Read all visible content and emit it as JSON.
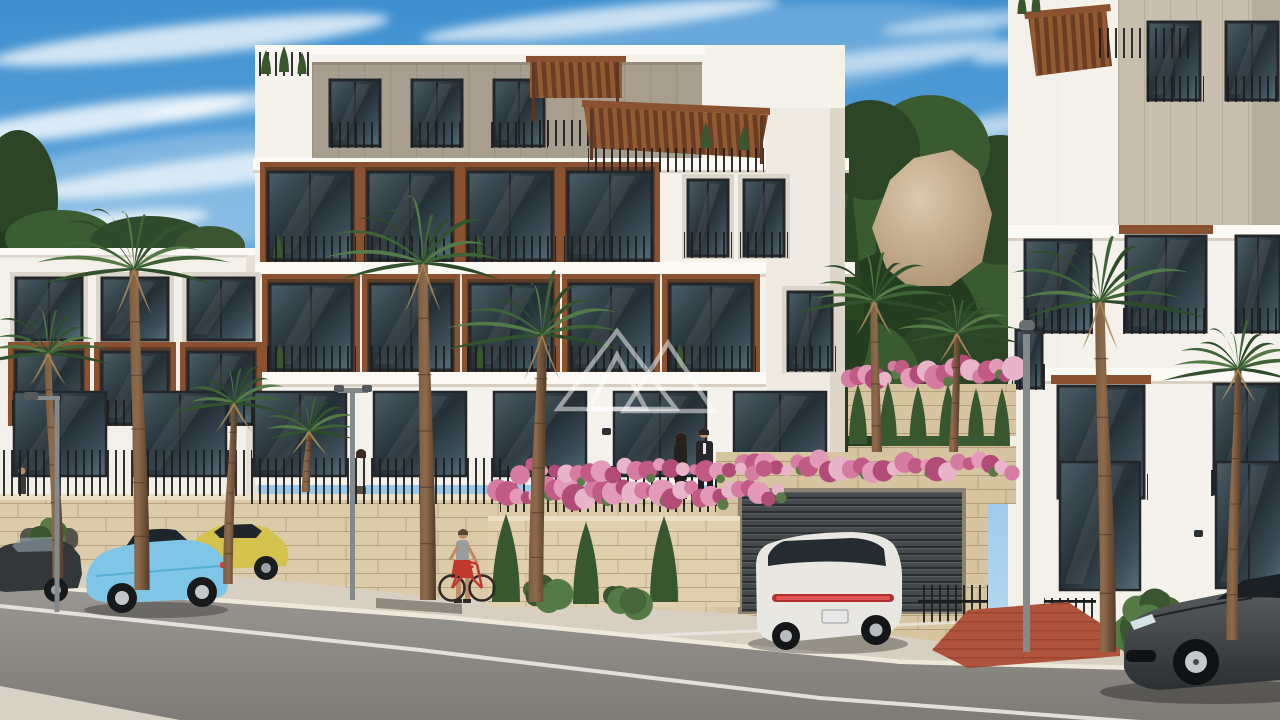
{
  "scene": {
    "type": "architectural-exterior-render",
    "description": "Sunny 3D architectural rendering of a modern white hillside apartment complex with wood pergola roof terraces, recessed wood-lined balconies, travertine stone retaining walls, an underground garage with dark roller door, a palm-lined street with parked cars, pedestrians, a cyclist, and a translucent triangle-logo watermark under a blue sky with streaky clouds",
    "time_of_day": "day",
    "watermark_style": "two overlapping translucent white triangle outlines"
  },
  "palette": {
    "sky_top": "#3e8fd0",
    "sky_low": "#c6dff2",
    "cloud": "#ffffff",
    "facade_white": "#f5f2ec",
    "facade_left": "#f3efe9",
    "facade_shade": "#e3dccf",
    "slab": "#fbf9f4",
    "penthouse_clad": "#a89e90",
    "beige_clad": "#c9bfae",
    "wood": "#8a5230",
    "wood_dark": "#6b3e23",
    "glass_dark": "#242f36",
    "frame_dark": "#23262a",
    "railing": "#1b1d1e",
    "stone": "#dccba8",
    "stone_dark": "#d6c5a0",
    "stone_line": "#96805c",
    "sidewalk": "#d7d0c2",
    "curb": "#efe9dc",
    "asphalt": "#8f8c86",
    "road_line": "#eceae4",
    "red_paving": "#b0533c",
    "garage_door": "#45494c",
    "forest_green": "#2c4527",
    "palm_green": "#3f6336",
    "cypress_green": "#39572f",
    "bougainvillea": "#d67ba1",
    "bougainvillea_deep": "#b14b78",
    "rock": "#c9b491",
    "car_blue": "#7fc5e8",
    "car_yellow": "#d4c24c",
    "car_white": "#e9e7e2",
    "car_dark": "#45484a",
    "car_black": "#34373a",
    "lamp_gray": "#84898c",
    "skin": "#bb8c67"
  },
  "sky": {
    "clouds": [
      [
        190,
        40,
        200,
        16,
        0.75,
        -6
      ],
      [
        90,
        120,
        160,
        14,
        0.8,
        -8
      ],
      [
        230,
        170,
        210,
        15,
        0.7,
        -7
      ],
      [
        60,
        230,
        150,
        13,
        0.75,
        -6
      ],
      [
        170,
        300,
        190,
        14,
        0.65,
        -8
      ],
      [
        40,
        370,
        140,
        12,
        0.6,
        -7
      ],
      [
        260,
        100,
        120,
        10,
        0.6,
        -10
      ],
      [
        120,
        420,
        150,
        10,
        0.5,
        -6
      ],
      [
        600,
        20,
        180,
        12,
        0.7,
        -6
      ],
      [
        880,
        60,
        140,
        11,
        0.55,
        -7
      ],
      [
        960,
        130,
        120,
        10,
        0.5,
        -6
      ],
      [
        1120,
        40,
        150,
        12,
        0.6,
        -8
      ],
      [
        1220,
        110,
        120,
        10,
        0.55,
        -7
      ],
      [
        1120,
        180,
        130,
        10,
        0.5,
        -6
      ],
      [
        1240,
        260,
        90,
        9,
        0.45,
        -7
      ],
      [
        990,
        20,
        110,
        9,
        0.5,
        -6
      ],
      [
        150,
        200,
        260,
        60,
        0.25,
        -8
      ],
      [
        700,
        60,
        300,
        50,
        0.2,
        -6
      ],
      [
        1150,
        120,
        200,
        45,
        0.2,
        -7
      ]
    ]
  },
  "windows": {
    "grids": [
      {
        "x": 330,
        "y": 80,
        "cols": 3,
        "w": 50,
        "h": 66,
        "gap": 32,
        "rail": true
      },
      {
        "x": 268,
        "y": 172,
        "cols": 4,
        "w": 84,
        "h": 88,
        "gap": 16,
        "wood": true,
        "rail": true,
        "plant": true
      },
      {
        "x": 688,
        "y": 180,
        "cols": 2,
        "w": 40,
        "h": 76,
        "gap": 16,
        "recess": "plain",
        "rail": true
      },
      {
        "x": 270,
        "y": 284,
        "cols": 5,
        "w": 82,
        "h": 86,
        "gap": 18,
        "wood": true,
        "rail": true,
        "plant": true
      },
      {
        "x": 788,
        "y": 292,
        "cols": 1,
        "w": 44,
        "h": 78,
        "gap": 0,
        "recess": "plain",
        "rail": true
      },
      {
        "x": 16,
        "y": 278,
        "cols": 3,
        "w": 66,
        "h": 62,
        "gap": 20,
        "recess": "plain"
      },
      {
        "x": 16,
        "y": 352,
        "cols": 3,
        "w": 66,
        "h": 72,
        "gap": 20,
        "wood": true,
        "rail": true
      },
      {
        "x": 14,
        "y": 392,
        "cols": 7,
        "w": 92,
        "h": 84,
        "gap": 28,
        "door": true
      },
      {
        "x": 1148,
        "y": 22,
        "cols": 2,
        "w": 52,
        "h": 78,
        "gap": 26,
        "rail": true
      },
      {
        "x": 1025,
        "y": 240,
        "cols": 1,
        "w": 66,
        "h": 92,
        "gap": 0,
        "rail": true
      },
      {
        "x": 1126,
        "y": 236,
        "cols": 1,
        "w": 80,
        "h": 96,
        "gap": 0,
        "rail": true,
        "lintel": true
      },
      {
        "x": 1236,
        "y": 236,
        "cols": 1,
        "w": 44,
        "h": 96,
        "gap": 0,
        "rail": true
      },
      {
        "x": 1016,
        "y": 330,
        "cols": 1,
        "w": 26,
        "h": 58,
        "gap": 0,
        "rail": true
      },
      {
        "x": 1058,
        "y": 386,
        "cols": 1,
        "w": 86,
        "h": 112,
        "gap": 0,
        "rail": true,
        "lintel": true
      },
      {
        "x": 1214,
        "y": 384,
        "cols": 1,
        "w": 66,
        "h": 110,
        "gap": 0,
        "rail": true
      },
      {
        "x": 1060,
        "y": 462,
        "cols": 1,
        "w": 80,
        "h": 128,
        "gap": 0,
        "door": true
      },
      {
        "x": 1216,
        "y": 462,
        "cols": 1,
        "w": 66,
        "h": 126,
        "gap": 0,
        "door": true
      }
    ]
  },
  "vegetation": {
    "street_palms": [
      [
        58,
        578,
        352,
        68,
        -10
      ],
      [
        142,
        590,
        268,
        95,
        -8
      ],
      [
        228,
        584,
        402,
        60,
        6
      ],
      [
        306,
        492,
        430,
        50,
        3
      ],
      [
        428,
        600,
        262,
        100,
        -5
      ],
      [
        536,
        602,
        334,
        92,
        6
      ],
      [
        1108,
        652,
        300,
        100,
        -8
      ],
      [
        1232,
        640,
        368,
        70,
        6
      ]
    ],
    "garden_palms": [
      [
        878,
        552,
        300,
        72,
        -4
      ],
      [
        952,
        545,
        332,
        62,
        5
      ]
    ],
    "cypresses": [
      {
        "l": "garden",
        "x": 858,
        "b": 444,
        "w": 18,
        "h": 60
      },
      {
        "l": "garden",
        "x": 888,
        "b": 446,
        "w": 18,
        "h": 64
      },
      {
        "l": "garden",
        "x": 918,
        "b": 444,
        "w": 17,
        "h": 58
      },
      {
        "l": "garden",
        "x": 948,
        "b": 446,
        "w": 18,
        "h": 62
      },
      {
        "l": "garden",
        "x": 976,
        "b": 444,
        "w": 16,
        "h": 56
      },
      {
        "l": "garden",
        "x": 1002,
        "b": 446,
        "w": 16,
        "h": 58
      },
      {
        "l": "flowerbed",
        "x": 506,
        "b": 602,
        "w": 28,
        "h": 88
      },
      {
        "l": "flowerbed",
        "x": 586,
        "b": 604,
        "w": 26,
        "h": 82
      },
      {
        "l": "flowerbed",
        "x": 664,
        "b": 602,
        "w": 28,
        "h": 86
      },
      {
        "l": "roof",
        "x": 266,
        "b": 74,
        "w": 10,
        "h": 24
      },
      {
        "l": "roof",
        "x": 284,
        "b": 72,
        "w": 10,
        "h": 26
      },
      {
        "l": "roof",
        "x": 302,
        "b": 74,
        "w": 9,
        "h": 22
      },
      {
        "l": "roof",
        "x": 706,
        "b": 148,
        "w": 10,
        "h": 26
      },
      {
        "l": "roof",
        "x": 744,
        "b": 150,
        "w": 10,
        "h": 24
      },
      {
        "l": "roof",
        "x": 1022,
        "b": 14,
        "w": 9,
        "h": 22
      },
      {
        "l": "roof",
        "x": 1036,
        "b": 12,
        "w": 9,
        "h": 24
      }
    ],
    "bushes": [
      {
        "l": "flowerbed",
        "x": 548,
        "y": 594,
        "r": 20
      },
      {
        "l": "flowerbed",
        "x": 628,
        "y": 596,
        "r": 20
      },
      {
        "l": "hedge",
        "x": 1128,
        "y": 636,
        "r": 26
      },
      {
        "l": "hedge",
        "x": 1152,
        "y": 614,
        "r": 22
      },
      {
        "l": "hedge",
        "x": 1172,
        "y": 638,
        "r": 24
      },
      {
        "l": "hedge",
        "x": 1250,
        "y": 626,
        "r": 24
      },
      {
        "l": "hedge",
        "x": 1270,
        "y": 602,
        "r": 20
      },
      {
        "l": "hedge",
        "x": 1282,
        "y": 636,
        "r": 22
      },
      {
        "l": "planter",
        "x": 48,
        "y": 534,
        "r": 16
      }
    ],
    "flower_rows": [
      {
        "l": "garden",
        "x0": 850,
        "x1": 1014,
        "y": 372,
        "n": 20,
        "r": 9
      },
      {
        "l": "garageTop",
        "x0": 744,
        "x1": 1012,
        "y": 466,
        "n": 26,
        "r": 9
      },
      {
        "l": "flowerbed",
        "x0": 498,
        "x1": 778,
        "y": 492,
        "n": 30,
        "r": 10
      },
      {
        "l": "flowerbed",
        "x0": 520,
        "x1": 764,
        "y": 470,
        "n": 22,
        "r": 8
      }
    ]
  },
  "vehicles": [
    {
      "name": "dark-sedan",
      "color": "car_black",
      "position": "far left, parked"
    },
    {
      "name": "yellow-hatchback",
      "color": "car_yellow",
      "position": "left, behind roadster"
    },
    {
      "name": "light-blue-roadster",
      "color": "car_blue",
      "position": "left foreground"
    },
    {
      "name": "white-suv",
      "color": "car_white",
      "position": "in front of garage door"
    },
    {
      "name": "dark-gray-sports-car",
      "color": "car_dark",
      "position": "bottom right"
    }
  ],
  "people": [
    {
      "name": "pedestrian-far-left"
    },
    {
      "name": "woman-on-walkway"
    },
    {
      "name": "couple-on-terrace"
    },
    {
      "name": "cyclist-with-red-bicycle"
    }
  ]
}
